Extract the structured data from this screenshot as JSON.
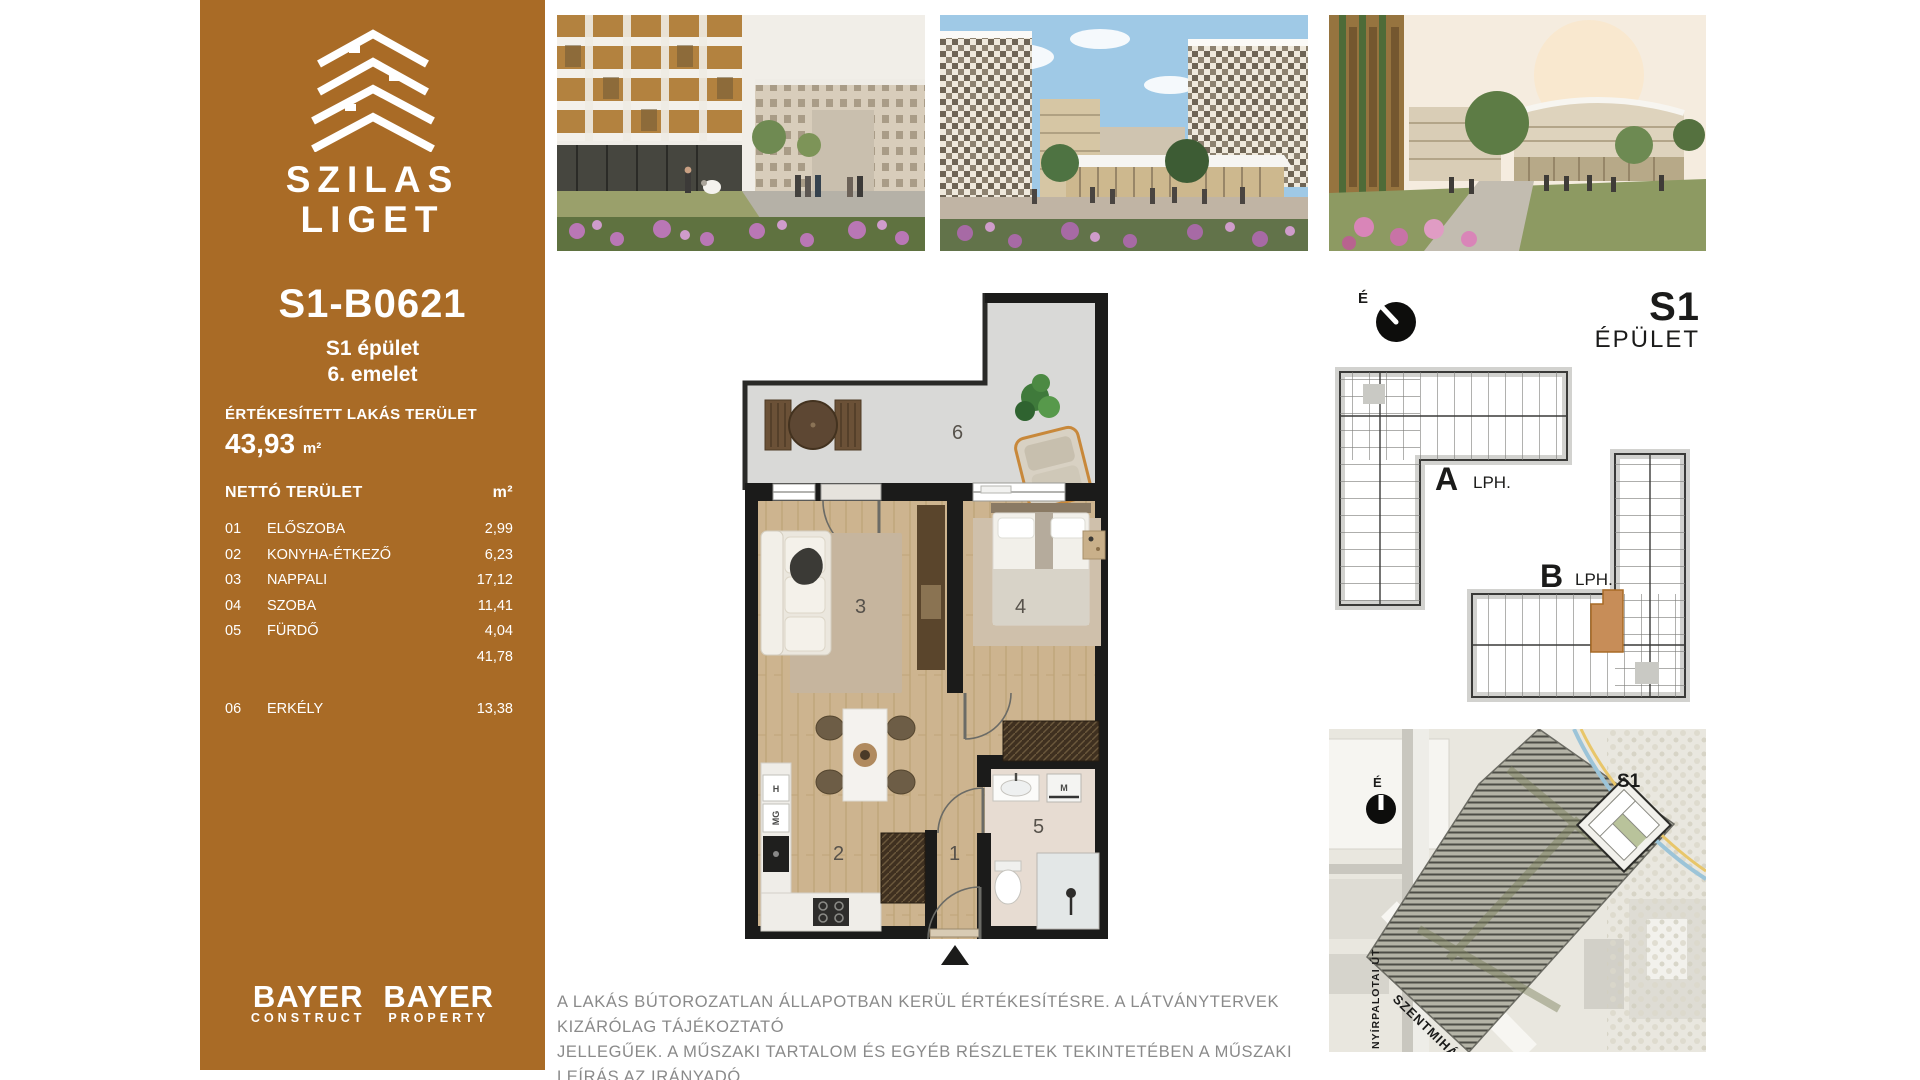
{
  "sidebar": {
    "brand": {
      "line1": "SZILAS",
      "line2": "LIGET"
    },
    "unit_id": "S1-B0621",
    "building": "S1 épület",
    "floor": "6. emelet",
    "sold_area_label": "ÉRTÉKESÍTETT LAKÁS TERÜLET",
    "sold_area_value": "43,93",
    "area_unit": "m²",
    "net_area_label": "NETTÓ TERÜLET",
    "rooms": [
      {
        "no": "01",
        "name": "ELŐSZOBA",
        "area": "2,99"
      },
      {
        "no": "02",
        "name": "KONYHA-ÉTKEZŐ",
        "area": "6,23"
      },
      {
        "no": "03",
        "name": "NAPPALI",
        "area": "17,12"
      },
      {
        "no": "04",
        "name": "SZOBA",
        "area": "11,41"
      },
      {
        "no": "05",
        "name": "FÜRDŐ",
        "area": "4,04"
      }
    ],
    "net_subtotal": "41,78",
    "extra_room": {
      "no": "06",
      "name": "ERKÉLY",
      "area": "13,38"
    },
    "logo1": {
      "top": "BAYER",
      "bottom": "CONSTRUCT"
    },
    "logo2": {
      "top": "BAYER",
      "bottom": "PROPERTY"
    }
  },
  "floorplan": {
    "rooms": {
      "hall": "1",
      "kitchen": "2",
      "living": "3",
      "bedroom": "4",
      "bath": "5",
      "balcony": "6"
    },
    "labels": {
      "h": "H",
      "mg": "MG",
      "m": "M"
    }
  },
  "keyplan": {
    "compass": "É",
    "building_code": "S1",
    "building_word": "ÉPÜLET",
    "stair_a": "A",
    "stair_b": "B",
    "stair_suffix": "LPH."
  },
  "sitemap": {
    "compass": "É",
    "building_code": "S1",
    "street_main": "SZENTMIHÁLYI ÚT",
    "street_side": "NYÍRPALOTAI ÚT"
  },
  "disclaimer": {
    "line1": "A LAKÁS BÚTOROZATLAN ÁLLAPOTBAN KERÜL ÉRTÉKESÍTÉSRE. A LÁTVÁNYTERVEK KIZÁRÓLAG TÁJÉKOZTATÓ",
    "line2": "JELLEGŰEK. A MŰSZAKI TARTALOM ÉS EGYÉB RÉSZLETEK TEKINTETÉBEN A MŰSZAKI LEÍRÁS AZ IRÁNYADÓ."
  },
  "colors": {
    "brand_brown": "#a96b26",
    "highlight_orange": "#c78d58"
  }
}
